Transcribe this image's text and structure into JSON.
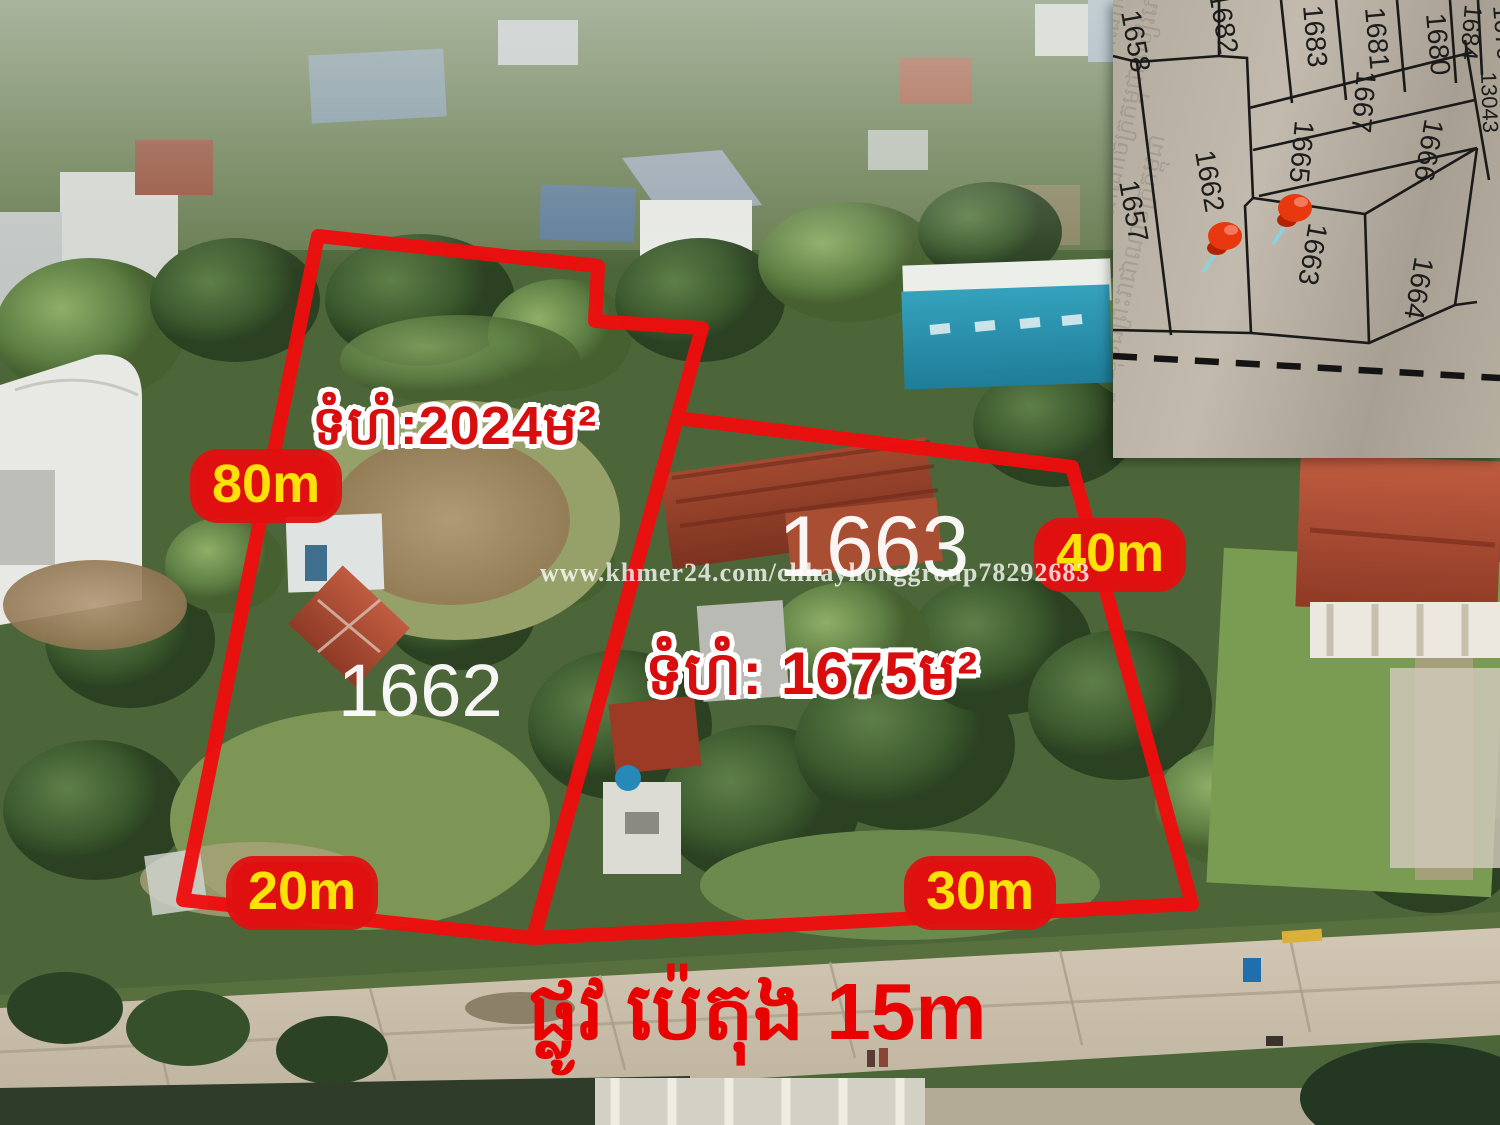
{
  "annotations": {
    "area_left": "ទំហំ:2024ម²",
    "area_right": "ទំហំ: 1675ម²",
    "plot_left_number": "1662",
    "plot_right_number": "1663",
    "dims": {
      "left_side": "80m",
      "left_bottom": "20m",
      "right_side": "40m",
      "right_bottom": "30m"
    },
    "road_label": "ផ្លូវ ប៉េតុង 15m",
    "watermark": "www.khmer24.com/chhayhonggroup78292683"
  },
  "inset_map": {
    "parcels": [
      "1658",
      "1682",
      "1683",
      "1681",
      "1680",
      "1684",
      "1679",
      "13043",
      "1667",
      "1666",
      "1665",
      "1662",
      "1657",
      "1663",
      "1664"
    ],
    "pinned_parcel": "1663",
    "road_style": "dashed-line",
    "texture_text": "ព្រះរាជាណាចក្រកម្ពុជា សៀវភៅគោលបញ្ជីដីធ្លី ឃុំបឹងព្រះរាជាណាចក្រកម្ពុជា សៀវភៅគោលបញ្ជីដីធ្លី ឃុំបឹង ព្រះរាជាណាចក្រកម្ពុជា សៀវភៅគោលបញ្ជីដីធ្លី ព្រះរាជាណាចក្រកម្ពុជា សៀវភៅគោល បញ្ជីដីធ្លី ឃុំបឹងព្រះរាជាណាចក្រកម្ពុជា"
  },
  "colors": {
    "boundary_red": "#ee0e0e",
    "dim_bg_red": "#e01010",
    "dim_text_yellow": "#ffe10a",
    "area_text_red": "#d80e0e",
    "road_text_red": "#e80202",
    "plot_number_white": "#ffffff",
    "pushpin_red": "#e8380f"
  }
}
